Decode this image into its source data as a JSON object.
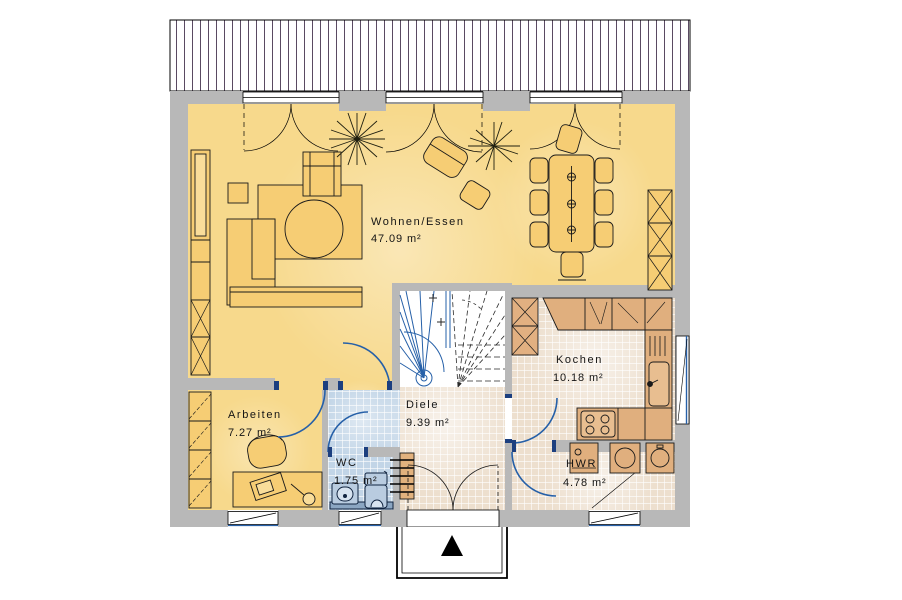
{
  "floor_plan": {
    "rooms": [
      {
        "name": "Wohnen/Essen",
        "area": "47.09 m²"
      },
      {
        "name": "Kochen",
        "area": "10.18 m²"
      },
      {
        "name": "Diele",
        "area": "9.39 m²"
      },
      {
        "name": "Arbeiten",
        "area": "7.27 m²"
      },
      {
        "name": "WC",
        "area": "1.75 m²"
      },
      {
        "name": "HWR",
        "area": "4.78 m²"
      }
    ],
    "colors": {
      "wall_gray": "#B8B8B8",
      "living_floor_yellow": "#F7D98C",
      "furniture_yellow": "#F6CD74",
      "tile_beige": "#EDDFCE",
      "tile_blue": "#C2D5E7",
      "kitchen_counter_tan": "#E0AF7E",
      "door_swing_blue": "#2660A8",
      "door_jamb_navy": "#1C3F7F",
      "deck_stripe": "#5A4A62"
    }
  }
}
